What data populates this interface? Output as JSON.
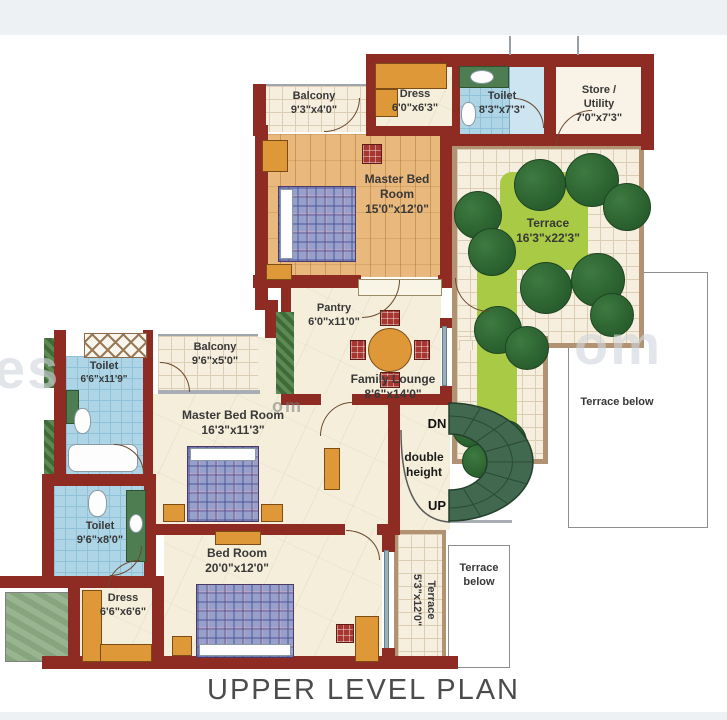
{
  "title": "UPPER LEVEL PLAN",
  "rooms": {
    "balcony_top": {
      "name": "Balcony",
      "size": "9'3\"x4'0\""
    },
    "dress_top": {
      "name": "Dress",
      "size": "6'0\"x6'3\""
    },
    "toilet_top": {
      "name": "Toilet",
      "size": "8'3\"x7'3\""
    },
    "store": {
      "name": "Store / Utility",
      "size": "7'0\"x7'3\""
    },
    "master_top": {
      "name": "Master Bed Room",
      "size": "15'0\"x12'0\""
    },
    "terrace_main": {
      "name": "Terrace",
      "size": "16'3\"x22'3\""
    },
    "pantry": {
      "name": "Pantry",
      "size": "6'0\"x11'0\""
    },
    "family_lounge": {
      "name": "Family Lounge",
      "size": "8'6\"x14'0\""
    },
    "balcony_mid": {
      "name": "Balcony",
      "size": "9'6\"x5'0\""
    },
    "toilet_mid": {
      "name": "Toilet",
      "size": "6'6\"x11'9\""
    },
    "master_mid": {
      "name": "Master Bed Room",
      "size": "16'3\"x11'3\""
    },
    "toilet_lower": {
      "name": "Toilet",
      "size": "9'6\"x8'0\""
    },
    "dress_lower": {
      "name": "Dress",
      "size": "6'6\"x6'6\""
    },
    "bedroom": {
      "name": "Bed Room",
      "size": "20'0\"x12'0\""
    },
    "terrace_strip": {
      "name": "Terrace",
      "size": "5'3\"x12'0\""
    },
    "terrace_below_right": {
      "name": "Terrace below"
    },
    "terrace_below_bottom": {
      "name": "Terrace below"
    }
  },
  "stair": {
    "down": "DN",
    "void": "double height",
    "up": "UP"
  },
  "watermark": {
    "left": "es",
    "right": "om",
    "small": "om"
  },
  "colors": {
    "wall": "#8e2b23",
    "wood": "#e9b87c",
    "tile": "#f6eede",
    "toilet": "#aed5e6",
    "lawn": "#a9ca45",
    "tree": "#2d6433",
    "furniture": "#de9838",
    "stair": "#41694f"
  }
}
